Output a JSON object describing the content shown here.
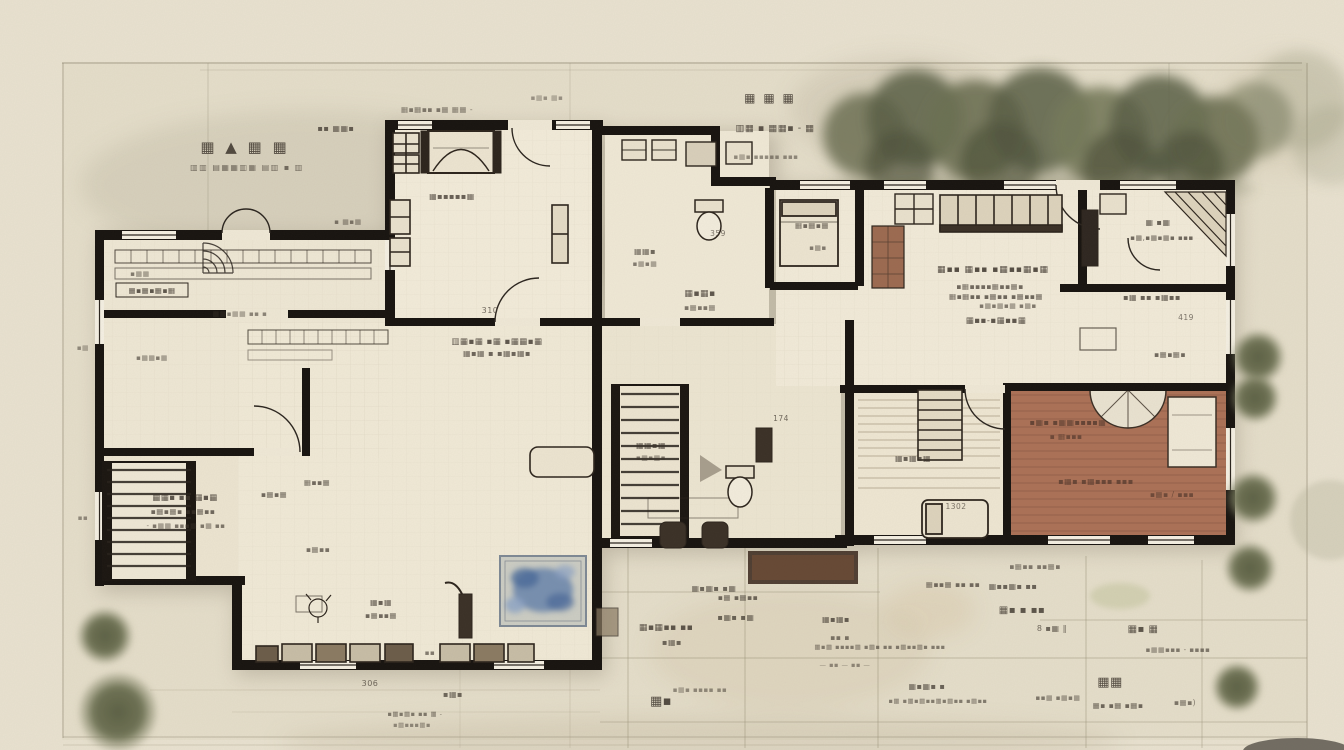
{
  "scene": {
    "kind": "hand-sketched architectural floor plan, top view",
    "paper_color": "#e9e2d0",
    "wall_color": "#17130f",
    "deck_color": "#ab7156",
    "deck_line_color": "#8d5a45",
    "rug_color": "#8ea6c4",
    "foliage_color": "#6b6e50",
    "ink_color": "#3a322a",
    "grid_color": "#9a9178"
  },
  "title_block": {
    "line1": "▦ ▲ ▦ ▦",
    "line2": "▥▥ ▤▦▦▥▦ ▤▥ ▪ ▥"
  },
  "labels": [
    {
      "text": "▪▪ ▦▦▪",
      "x": 336,
      "y": 131,
      "s": 8,
      "o": 0.75
    },
    {
      "text": "▦▪▦▪▪ ▪▦ ▦▦ -",
      "x": 437,
      "y": 112,
      "s": 7.5,
      "o": 0.6
    },
    {
      "text": "▦ ▦ ▦",
      "x": 770,
      "y": 102,
      "s": 12,
      "o": 0.85,
      "ls": 2
    },
    {
      "text": "▥▦ ▪ ▦▦▪ - ▦",
      "x": 775,
      "y": 131,
      "s": 9.5,
      "o": 0.8
    },
    {
      "text": "▪▦▪ ▪▪▪▪▪ ▪▪▪",
      "x": 766,
      "y": 159,
      "s": 7,
      "o": 0.5
    },
    {
      "text": "▦▪▪▪▪▪▦",
      "x": 452,
      "y": 199,
      "s": 8,
      "o": 0.75
    },
    {
      "text": "▪ ▦▪▦",
      "x": 348,
      "y": 224,
      "s": 7,
      "o": 0.6
    },
    {
      "text": "▪▦▦",
      "x": 140,
      "y": 276,
      "s": 7,
      "o": 0.6
    },
    {
      "text": "▦▪▦▪▦▪▦",
      "x": 152,
      "y": 293,
      "s": 7.5,
      "o": 0.8
    },
    {
      "text": "▦▦▪▦▦ ▪▪ ▪",
      "x": 240,
      "y": 316,
      "s": 7,
      "o": 0.55
    },
    {
      "text": "▥▦▪▦ ▪▦ ▪▦▦▪▦",
      "x": 497,
      "y": 344,
      "s": 8.5,
      "o": 0.8
    },
    {
      "text": "▦▪▦ ▪ ▪▦▪▦▪",
      "x": 497,
      "y": 356,
      "s": 8,
      "o": 0.72
    },
    {
      "text": "▪▦▦▪▦",
      "x": 152,
      "y": 360,
      "s": 7,
      "o": 0.6
    },
    {
      "text": "310",
      "x": 490,
      "y": 313,
      "s": 8,
      "o": 0.7
    },
    {
      "text": "▦▦▪ ▪▪ ▦▪▦",
      "x": 185,
      "y": 500,
      "s": 8.5,
      "o": 0.8
    },
    {
      "text": "▪▦▪▦▪ ▪▪▦▪▪",
      "x": 183,
      "y": 514,
      "s": 7.5,
      "o": 0.7
    },
    {
      "text": "- ▪▦▦ ▪▪▪▦ ▪▦ ▪▪",
      "x": 186,
      "y": 528,
      "s": 7,
      "o": 0.62
    },
    {
      "text": "▪▦▪▦",
      "x": 274,
      "y": 497,
      "s": 7.5,
      "o": 0.7
    },
    {
      "text": "▦▪▪▦",
      "x": 317,
      "y": 485,
      "s": 7.5,
      "o": 0.7
    },
    {
      "text": "▪▦▪▪",
      "x": 318,
      "y": 552,
      "s": 7.5,
      "o": 0.65
    },
    {
      "text": "▦▪▦",
      "x": 381,
      "y": 605,
      "s": 8,
      "o": 0.75
    },
    {
      "text": "▪▦▪▪▦",
      "x": 381,
      "y": 618,
      "s": 7.5,
      "o": 0.7
    },
    {
      "text": "▪▪",
      "x": 430,
      "y": 655,
      "s": 7,
      "o": 0.6
    },
    {
      "text": "▪▦▪",
      "x": 453,
      "y": 697,
      "s": 8,
      "o": 0.7
    },
    {
      "text": "306",
      "x": 370,
      "y": 686,
      "s": 8,
      "o": 0.7
    },
    {
      "text": "▪▦▪▦▪ ▪▪ ▦ -",
      "x": 415,
      "y": 716,
      "s": 6.5,
      "o": 0.6
    },
    {
      "text": "▪▦▪▪▪▦▪",
      "x": 412,
      "y": 727,
      "s": 6.5,
      "o": 0.5
    },
    {
      "text": "▦▦▪",
      "x": 645,
      "y": 254,
      "s": 8,
      "o": 0.7
    },
    {
      "text": "▪▦▪▦",
      "x": 645,
      "y": 266,
      "s": 7,
      "o": 0.6
    },
    {
      "text": "▦▪▦▪",
      "x": 700,
      "y": 296,
      "s": 9,
      "o": 0.8
    },
    {
      "text": "▪▦▪▪▦",
      "x": 700,
      "y": 310,
      "s": 7.5,
      "o": 0.62
    },
    {
      "text": "359",
      "x": 718,
      "y": 236,
      "s": 7.5,
      "o": 0.65
    },
    {
      "text": "▦▦▪▦",
      "x": 651,
      "y": 448,
      "s": 8,
      "o": 0.75
    },
    {
      "text": "▪▦▪▦▪",
      "x": 651,
      "y": 460,
      "s": 7,
      "o": 0.6
    },
    {
      "text": "▦▪▦▪ ▪▦",
      "x": 714,
      "y": 591,
      "s": 8,
      "o": 0.7
    },
    {
      "text": "174",
      "x": 781,
      "y": 421,
      "s": 7.5,
      "o": 0.7
    },
    {
      "text": "▦▪▦▪▦",
      "x": 812,
      "y": 228,
      "s": 7.5,
      "o": 0.7
    },
    {
      "text": "▪▦▪",
      "x": 818,
      "y": 250,
      "s": 7,
      "o": 0.6
    },
    {
      "text": "▦▪▪ ▦▪▪ ▪▦▪▪▦▪▦",
      "x": 993,
      "y": 272,
      "s": 9,
      "o": 0.85,
      "ls": 1
    },
    {
      "text": "▪▦▪▪▪▪▦▪▪▦▪",
      "x": 990,
      "y": 289,
      "s": 7.5,
      "o": 0.7
    },
    {
      "text": "▦▪▦▪▪ ▪▦▪▪ ▪▦▪▪▦",
      "x": 996,
      "y": 299,
      "s": 7.5,
      "o": 0.72
    },
    {
      "text": "▪▦▪▦▪▦ ▪▦▪",
      "x": 1008,
      "y": 308,
      "s": 7,
      "o": 0.62
    },
    {
      "text": "▦▪▪-▪▦▪▪▦",
      "x": 996,
      "y": 323,
      "s": 8.5,
      "o": 0.8
    },
    {
      "text": "▦ ▪▦",
      "x": 1158,
      "y": 225,
      "s": 8,
      "o": 0.75
    },
    {
      "text": "▪▦,▪▦▪▦▪ ▪▪▪",
      "x": 1162,
      "y": 240,
      "s": 7,
      "o": 0.7
    },
    {
      "text": "▪▦ ▪▪ ▪▦▪▪",
      "x": 1152,
      "y": 300,
      "s": 8,
      "o": 0.75
    },
    {
      "text": "419",
      "x": 1186,
      "y": 320,
      "s": 7.5,
      "o": 0.65
    },
    {
      "text": "▪▦▪▦▪",
      "x": 1170,
      "y": 357,
      "s": 7.5,
      "o": 0.7
    },
    {
      "text": "▦▪▦▪▦",
      "x": 913,
      "y": 461,
      "s": 8,
      "o": 0.75
    },
    {
      "text": "1302",
      "x": 956,
      "y": 509,
      "s": 7.5,
      "o": 0.65
    },
    {
      "text": "▪▦▪ ▪▦▦▪▪▪▪▦",
      "x": 1068,
      "y": 425,
      "s": 8,
      "o": 0.8,
      "c": "#53382c"
    },
    {
      "text": "▪ ▦▪▪▪",
      "x": 1066,
      "y": 439,
      "s": 7.5,
      "o": 0.7,
      "c": "#53382c"
    },
    {
      "text": "▪▦▪ ▪▦▪▪▪ ▪▪▪",
      "x": 1096,
      "y": 484,
      "s": 8,
      "o": 0.75,
      "c": "#53382c"
    },
    {
      "text": "▪▦▪ / ▪▪▪",
      "x": 1172,
      "y": 497,
      "s": 7.5,
      "o": 0.7,
      "c": "#53382c"
    },
    {
      "text": "▪▦▪▪ ▪▪▦▪",
      "x": 1035,
      "y": 569,
      "s": 7.5,
      "o": 0.6
    },
    {
      "text": "▦▪▦▪▪ ▪▪",
      "x": 666,
      "y": 630,
      "s": 9,
      "o": 0.8
    },
    {
      "text": "▪▦▪",
      "x": 672,
      "y": 645,
      "s": 8,
      "o": 0.7
    },
    {
      "text": "▪▦ ▪▦▪▪",
      "x": 738,
      "y": 600,
      "s": 7.5,
      "o": 0.7
    },
    {
      "text": "▪▦▪ ▪▦",
      "x": 736,
      "y": 620,
      "s": 8,
      "o": 0.72
    },
    {
      "text": "▦▪▦▪",
      "x": 836,
      "y": 622,
      "s": 8,
      "o": 0.75
    },
    {
      "text": "▪▪ ▪",
      "x": 840,
      "y": 640,
      "s": 7.5,
      "o": 0.62
    },
    {
      "text": "▦▪▦ ▪▪▪▪▦ ▪▦▪ ▪▪ ▪▦▪▪▦▪ ▪▪▪",
      "x": 880,
      "y": 649,
      "s": 6.5,
      "o": 0.58
    },
    {
      "text": "— ▪▪ — ▪▪ —",
      "x": 845,
      "y": 667,
      "s": 6.5,
      "o": 0.5
    },
    {
      "text": "▦▪▪▦▪ ▪▪",
      "x": 1013,
      "y": 589,
      "s": 8,
      "o": 0.72
    },
    {
      "text": "▦▪ ▪ ▪▪",
      "x": 1022,
      "y": 613,
      "s": 10,
      "o": 0.8
    },
    {
      "text": "8 ▪▦ ‖",
      "x": 1052,
      "y": 631,
      "s": 8,
      "o": 0.7
    },
    {
      "text": "▦▪ ▦",
      "x": 1143,
      "y": 632,
      "s": 10,
      "o": 0.8
    },
    {
      "text": "▪▦▦▪▪▪ - ▪▪▪▪",
      "x": 1178,
      "y": 652,
      "s": 7,
      "o": 0.6
    },
    {
      "text": "▦▦",
      "x": 1110,
      "y": 686,
      "s": 13,
      "o": 0.85
    },
    {
      "text": "▪▪▦ ▪▦▪▦",
      "x": 1058,
      "y": 700,
      "s": 7,
      "o": 0.6
    },
    {
      "text": "▦▪ ▪▦ ▪▦▪",
      "x": 1118,
      "y": 708,
      "s": 7.5,
      "o": 0.7
    },
    {
      "text": "▪▦▪)",
      "x": 1185,
      "y": 705,
      "s": 7.5,
      "o": 0.62
    },
    {
      "text": "▦▪▦▪ ▪",
      "x": 927,
      "y": 689,
      "s": 8,
      "o": 0.72
    },
    {
      "text": "▪▦ ▪▦▪▦▪▪▦▪▦▪▪ ▪▦▪▪",
      "x": 938,
      "y": 703,
      "s": 6.5,
      "o": 0.58
    },
    {
      "text": "▦▪",
      "x": 661,
      "y": 705,
      "s": 13,
      "o": 0.85
    },
    {
      "text": "▪▦▪ ▪▪▪▪ ▪▪",
      "x": 700,
      "y": 692,
      "s": 7,
      "o": 0.5
    },
    {
      "text": "▦▪▪▦ ▪▪ ▪▪",
      "x": 953,
      "y": 587,
      "s": 7.5,
      "o": 0.68
    },
    {
      "text": "▪▦",
      "x": 83,
      "y": 350,
      "s": 7,
      "o": 0.5
    },
    {
      "text": "▪▪",
      "x": 83,
      "y": 520,
      "s": 7,
      "o": 0.5
    },
    {
      "text": "▪▦▪ ▦▪",
      "x": 547,
      "y": 100,
      "s": 7,
      "o": 0.45
    }
  ]
}
